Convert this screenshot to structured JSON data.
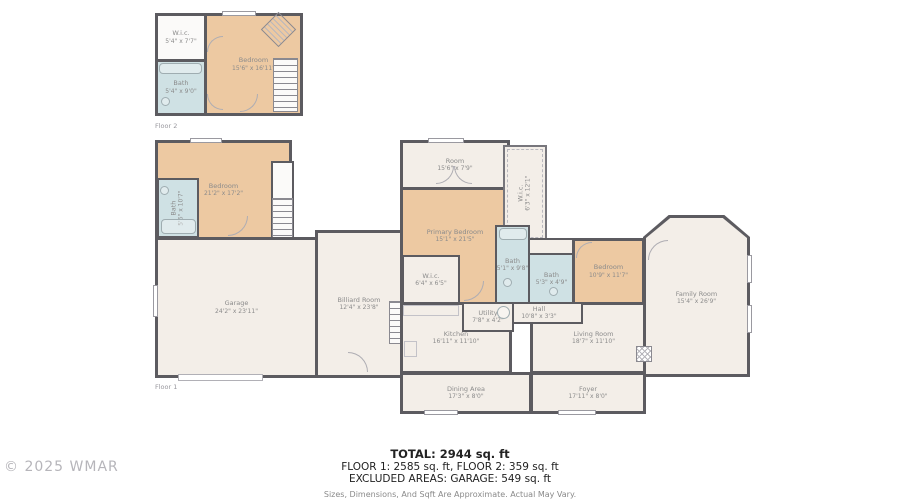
{
  "watermark": "© 2025 WMAR",
  "floor_labels": {
    "floor1": "Floor 1",
    "floor2": "Floor 2"
  },
  "summary": {
    "total": "TOTAL: 2944 sq. ft",
    "floors": "FLOOR 1: 2585 sq. ft, FLOOR 2: 359 sq. ft",
    "excluded": "EXCLUDED AREAS: GARAGE: 549 sq. ft",
    "disclaimer": "Sizes, Dimensions, And Sqft Are Approximate. Actual May Vary."
  },
  "colors": {
    "wall": "#5c5b60",
    "bedroom_fill": "#edc9a2",
    "bath_fill": "#cfe1e4",
    "room_fill": "#f3eee8",
    "label_text": "#8b8b8b"
  },
  "rooms": {
    "f2_wic": {
      "name": "W.i.c.",
      "dims": "5'4\" x 7'7\""
    },
    "f2_bath": {
      "name": "Bath",
      "dims": "5'4\" x 9'0\""
    },
    "f2_bedroom": {
      "name": "Bedroom",
      "dims": "15'6\" x 16'11\""
    },
    "f1_bedroom": {
      "name": "Bedroom",
      "dims": "21'2\" x 17'2\""
    },
    "f1_bath": {
      "name": "Bath",
      "dims": "5'6\" x 10'7\""
    },
    "garage": {
      "name": "Garage",
      "dims": "24'2\" x 23'11\""
    },
    "billiard": {
      "name": "Billiard Room",
      "dims": "12'4\" x 23'8\""
    },
    "room": {
      "name": "Room",
      "dims": "15'6\" x 7'9\""
    },
    "wic_upper": {
      "name": "W.i.c.",
      "dims": "6'3\" x 12'1\""
    },
    "primary_bedroom": {
      "name": "Primary Bedroom",
      "dims": "15'1\" x 21'5\""
    },
    "primary_wic": {
      "name": "W.i.c.",
      "dims": "6'4\" x 6'5\""
    },
    "primary_bath": {
      "name": "Bath",
      "dims": "5'1\" x 9'8\""
    },
    "hall_bath": {
      "name": "Bath",
      "dims": "5'3\" x 4'9\""
    },
    "hall": {
      "name": "Hall",
      "dims": "10'8\" x 3'3\""
    },
    "bedroom_right": {
      "name": "Bedroom",
      "dims": "10'9\" x 11'7\""
    },
    "family_room": {
      "name": "Family Room",
      "dims": "15'4\" x 26'9\""
    },
    "kitchen": {
      "name": "Kitchen",
      "dims": "16'11\" x 11'10\""
    },
    "utility": {
      "name": "Utility",
      "dims": "7'8\" x 4'2\""
    },
    "dining": {
      "name": "Dining Area",
      "dims": "17'3\" x 8'0\""
    },
    "living": {
      "name": "Living Room",
      "dims": "18'7\" x 11'10\""
    },
    "foyer": {
      "name": "Foyer",
      "dims": "17'11\" x 8'0\""
    }
  }
}
